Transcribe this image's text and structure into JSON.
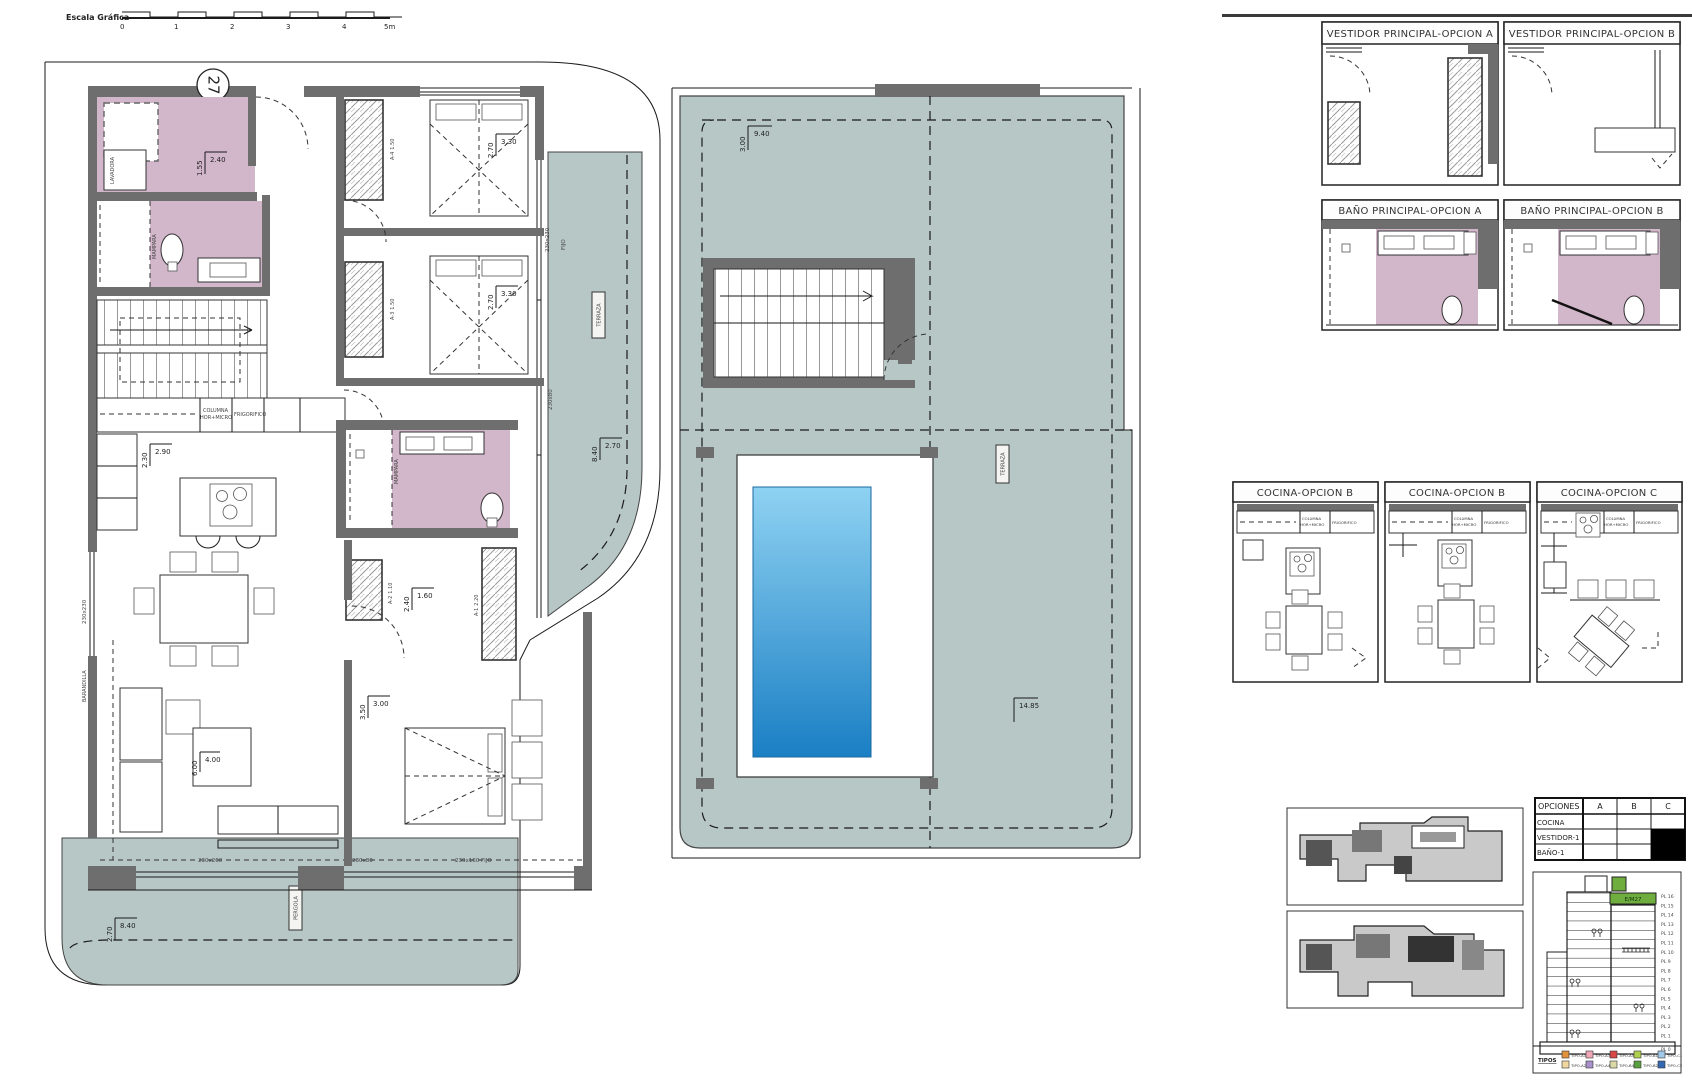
{
  "colors": {
    "terrace": "#b6c7c5",
    "bath_pink": "#d2b6ca",
    "wall_gray": "#6e6e6e",
    "pool_light": "#8fd2f2",
    "pool_dark": "#1a7fc4",
    "highlight_green": "#6fae3e"
  },
  "scale_bar": {
    "label": "Escala Gráfica",
    "ticks": [
      "0",
      "1",
      "2",
      "3",
      "4",
      "5m"
    ]
  },
  "unit_marker": {
    "number": "27"
  },
  "plan": {
    "labels": {
      "lavadora": "LAVADORA",
      "mampara1": "MAMPARA",
      "mampara2": "MAMPARA",
      "terraza": "TERRAZA",
      "pergola": "PERGOLA",
      "barandilla": "BARANDILLA",
      "columna": "COLUMNA",
      "hor_micro": "HOR+MICRO",
      "frigorifico": "FRIGORIFICO",
      "a4": "A-4",
      "a4_d": "1.50",
      "a3": "A-3",
      "a3_d": "1.50",
      "a1": "A-1",
      "a1_d": "2.20",
      "a2": "A-2",
      "a2_d": "1.10"
    },
    "dims": {
      "bath1_w": "2.40",
      "bath1_h": "1.55",
      "bed1_w": "3.30",
      "bed1_h": "2.70",
      "bed2_w": "3.30",
      "bed2_h": "2.70",
      "kitchen_w": "2.90",
      "kitchen_h": "2.30",
      "terrace_e_w": "2.70",
      "terrace_e_h": "8.40",
      "closet_w": "1.60",
      "closet_h": "2.40",
      "bed3_w": "3.00",
      "bed3_h": "3.50",
      "living_w": "4.00",
      "living_h": "6.00",
      "terrace_s_w": "8.40",
      "terrace_s_h": "2.70"
    },
    "windows": {
      "w1": "230x230",
      "w1b": "FIJO",
      "w2": "230x80",
      "w3": "OR14",
      "w3b": "230x70",
      "w4": "230x260",
      "w5": "230x80",
      "w6": "230x160 FIJO"
    }
  },
  "roof": {
    "dims": {
      "top_w": "9.40",
      "top_h": "3.00",
      "right_h": "14.85"
    },
    "labels": {
      "terraza": "TERRAZA"
    }
  },
  "panels": {
    "vestidor_a": "VESTIDOR PRINCIPAL-OPCION A",
    "vestidor_b": "VESTIDOR PRINCIPAL-OPCION B",
    "bano_a": "BAÑO PRINCIPAL-OPCION A",
    "bano_b": "BAÑO PRINCIPAL-OPCION B",
    "cocina_1": "COCINA-OPCION B",
    "cocina_2": "COCINA-OPCION B",
    "cocina_3": "COCINA-OPCION C",
    "columna": "COLUMNA",
    "hor_micro": "HOR+MICRO",
    "frigorifico": "FRIGORIFICO"
  },
  "options_table": {
    "header": [
      "OPCIONES",
      "A",
      "B",
      "C"
    ],
    "rows": [
      {
        "label": "COCINA",
        "filled": [
          false,
          false,
          false
        ]
      },
      {
        "label": "VESTIDOR-1",
        "filled": [
          false,
          false,
          true
        ]
      },
      {
        "label": "BAÑO-1",
        "filled": [
          false,
          false,
          true
        ]
      }
    ]
  },
  "elevation": {
    "highlight": "E/M27",
    "floors": [
      "PL 16",
      "PL 15",
      "PL 14",
      "PL 13",
      "PL 12",
      "PL 11",
      "PL 10",
      "PL 9",
      "PL 8",
      "PL 7",
      "PL 6",
      "PL 5",
      "PL 4",
      "PL 3",
      "PL 2",
      "PL 1",
      "PL 0"
    ],
    "legend_title": "TIPOS",
    "legend": [
      {
        "label": "TIPO-A1",
        "color": "#e2913c"
      },
      {
        "label": "TIPO-A3",
        "color": "#f0a8b8"
      },
      {
        "label": "TIPO-A5",
        "color": "#d84848"
      },
      {
        "label": "TIPO-B1",
        "color": "#aed04e"
      },
      {
        "label": "TIPO-C1",
        "color": "#a0c8e8"
      },
      {
        "label": "TIPO-A2",
        "color": "#f0d8a0"
      },
      {
        "label": "TIPO-A4",
        "color": "#a890cc"
      },
      {
        "label": "TIPO-B4",
        "color": "#d8d8a8"
      },
      {
        "label": "TIPO-B2",
        "color": "#58a040"
      },
      {
        "label": "TIPO-C2",
        "color": "#3468b0"
      }
    ]
  }
}
